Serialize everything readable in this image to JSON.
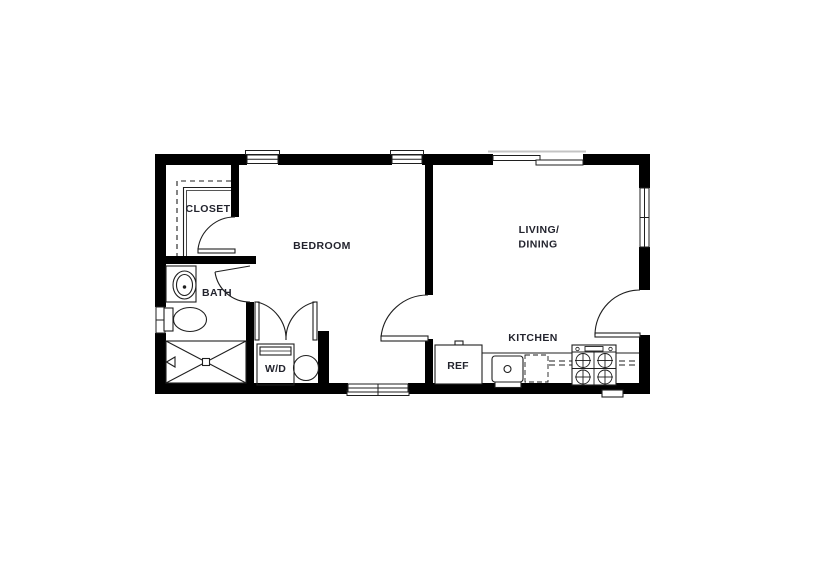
{
  "colors": {
    "wall": "#000000",
    "line": "#1f1f1f",
    "line_light": "#c4c4c4",
    "label": "#23242e",
    "background": "#ffffff"
  },
  "labels": {
    "closet": "CLOSET",
    "bedroom": "BEDROOM",
    "bath": "BATH",
    "washer_dryer": "W/D",
    "living_line1": "LIVING/",
    "living_line2": "DINING",
    "kitchen": "KITCHEN",
    "refrigerator": "REF"
  }
}
